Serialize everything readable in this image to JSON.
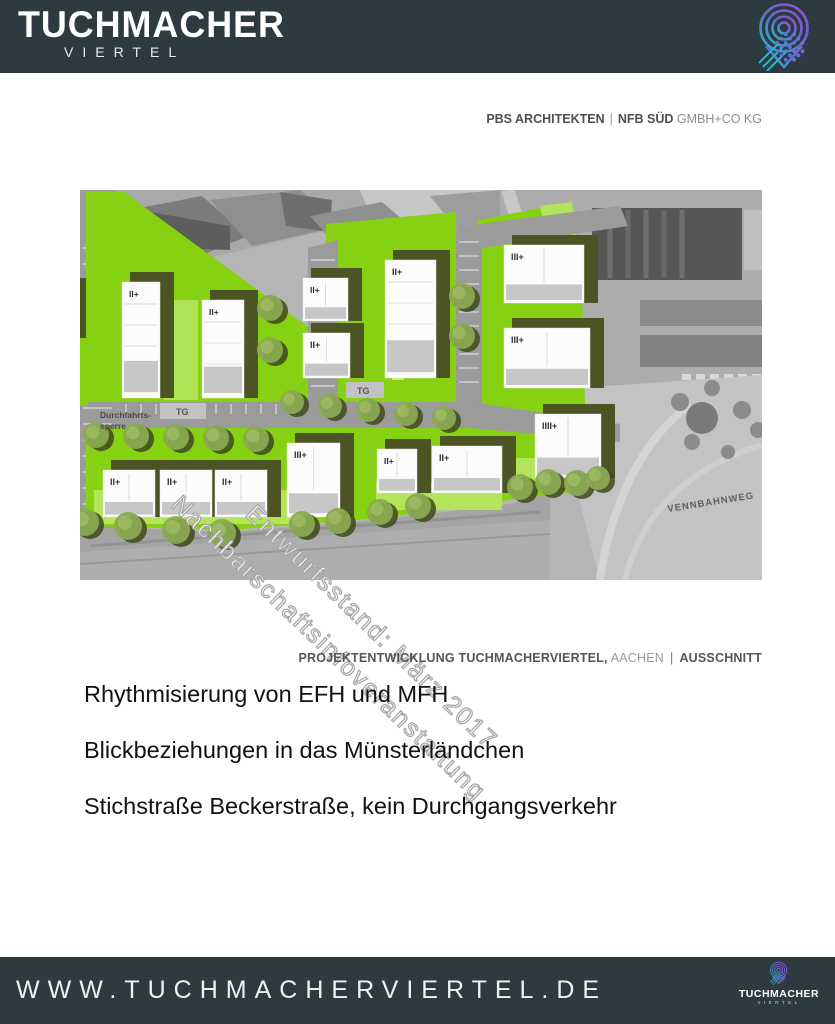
{
  "header": {
    "brand_line1": "TUCHMACHER",
    "brand_line2": "VIERTEL",
    "logo_icon": "location-pin-rings-icon"
  },
  "credits": {
    "architect": "PBS ARCHITEKTEN",
    "separator": "|",
    "developer": "NFB SÜD",
    "developer_suffix": "GMBH+CO KG"
  },
  "plan": {
    "building_labels": [
      "II+",
      "II+",
      "II+",
      "II+",
      "II+",
      "III+",
      "III+",
      "II+",
      "II+",
      "II+",
      "III+",
      "II+",
      "II+",
      "IIII+"
    ],
    "labels": {
      "tg1": "TG",
      "tg2": "TG",
      "barrier_line1": "Durchfahrts-",
      "barrier_line2": "sperre",
      "street_name": "VENNBAHNWEG"
    },
    "watermark": {
      "line1": "Entwurfsstand: März 2017",
      "line2": "Nachbarschaftsinfoveranstaltung"
    },
    "colors": {
      "green": "#86d111",
      "light_green": "#b4e459",
      "tree": "#8aa952",
      "tree_shadow": "#3e481d",
      "building_shadow": "#4d5424",
      "road": "#9b9b9b",
      "aerial_base": "#b5b5b5"
    }
  },
  "caption": {
    "project": "PROJEKTENTWICKLUNG TUCHMACHERVIERTEL,",
    "city": "AACHEN",
    "separator": "|",
    "detail": "AUSSCHNITT"
  },
  "bullets": [
    "Rhythmisierung von EFH und MFH",
    "Blickbeziehungen in das Münsterländchen",
    "Stichstraße Beckerstraße, kein Durchgangsverkehr"
  ],
  "footer": {
    "url": "WWW.TUCHMACHERVIERTEL.DE",
    "brand_line1": "TUCHMACHER",
    "brand_line2": "VIERTEL"
  },
  "theme": {
    "header_bg": "#2d3a40"
  }
}
